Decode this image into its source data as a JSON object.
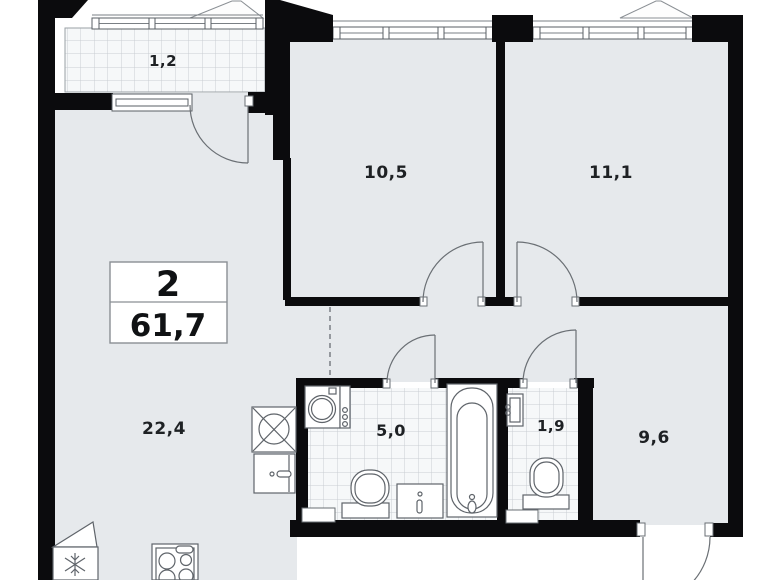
{
  "plan": {
    "info_box": {
      "rooms_count": "2",
      "total_area": "61,7"
    },
    "rooms": {
      "balcony": {
        "area": "1,2"
      },
      "bedroom1": {
        "area": "10,5"
      },
      "bedroom2": {
        "area": "11,1"
      },
      "living_kitchen": {
        "area": "22,4"
      },
      "bathroom": {
        "area": "5,0"
      },
      "wc": {
        "area": "1,9"
      },
      "hall": {
        "area": "9,6"
      }
    },
    "fixtures": [
      "washing-machine",
      "toilet",
      "sink-vanity",
      "bathtub",
      "wc-sink",
      "wc-toilet",
      "kitchen-sink",
      "kitchen-cabinet",
      "fridge",
      "stove"
    ],
    "colors": {
      "wall": "#0b0b0d",
      "floor": "#e6e9ec",
      "tile_bg": "#f6f8f9",
      "tile_line": "#c9ced3",
      "outline": "#5f646a",
      "background": "#ffffff"
    }
  }
}
